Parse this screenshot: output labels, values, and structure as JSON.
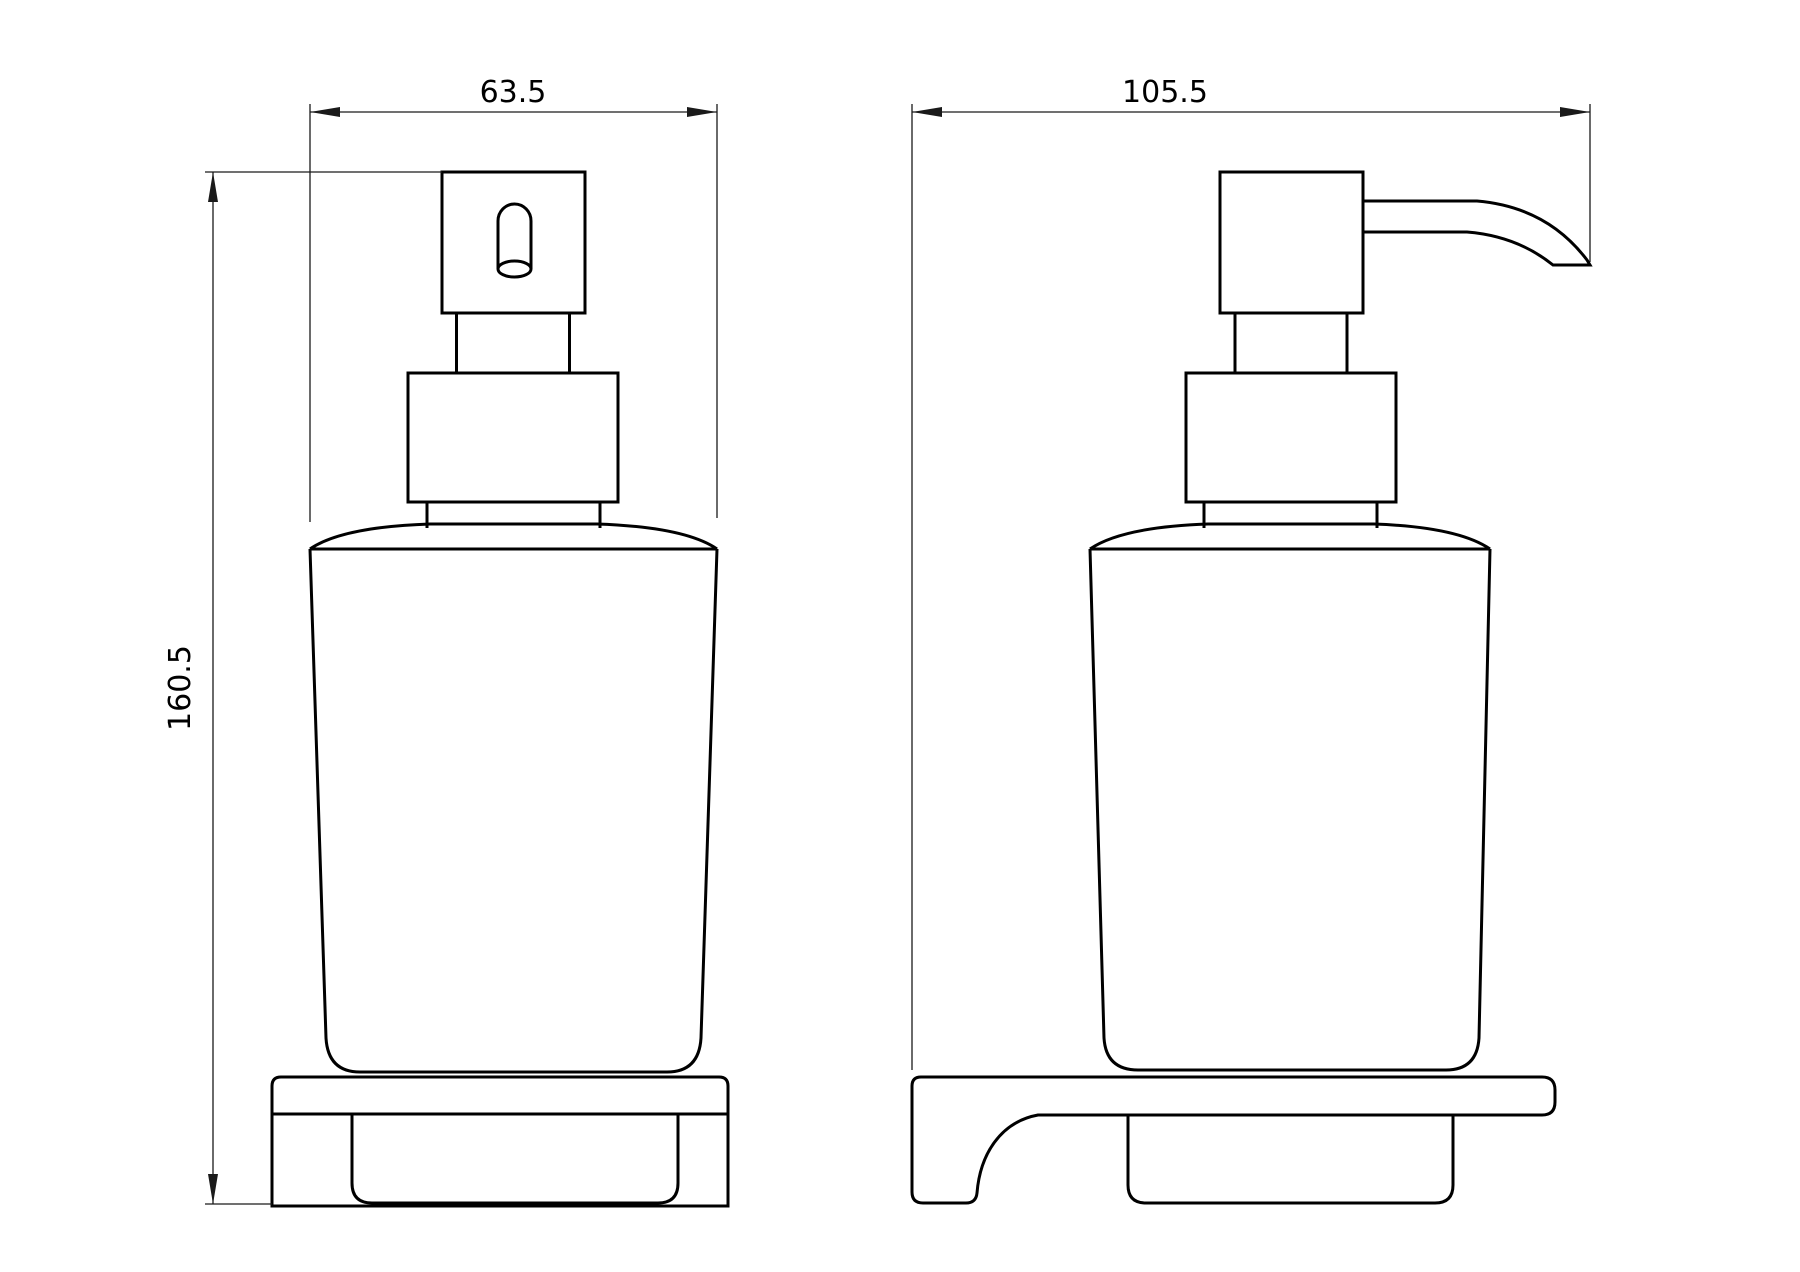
{
  "drawing": {
    "dimensions": {
      "front_width": "63.5",
      "side_depth": "105.5",
      "overall_height": "160.5"
    },
    "colors": {
      "background": "#ffffff",
      "outline": "#000000",
      "dimension_lines": "#1a1a1a"
    }
  }
}
